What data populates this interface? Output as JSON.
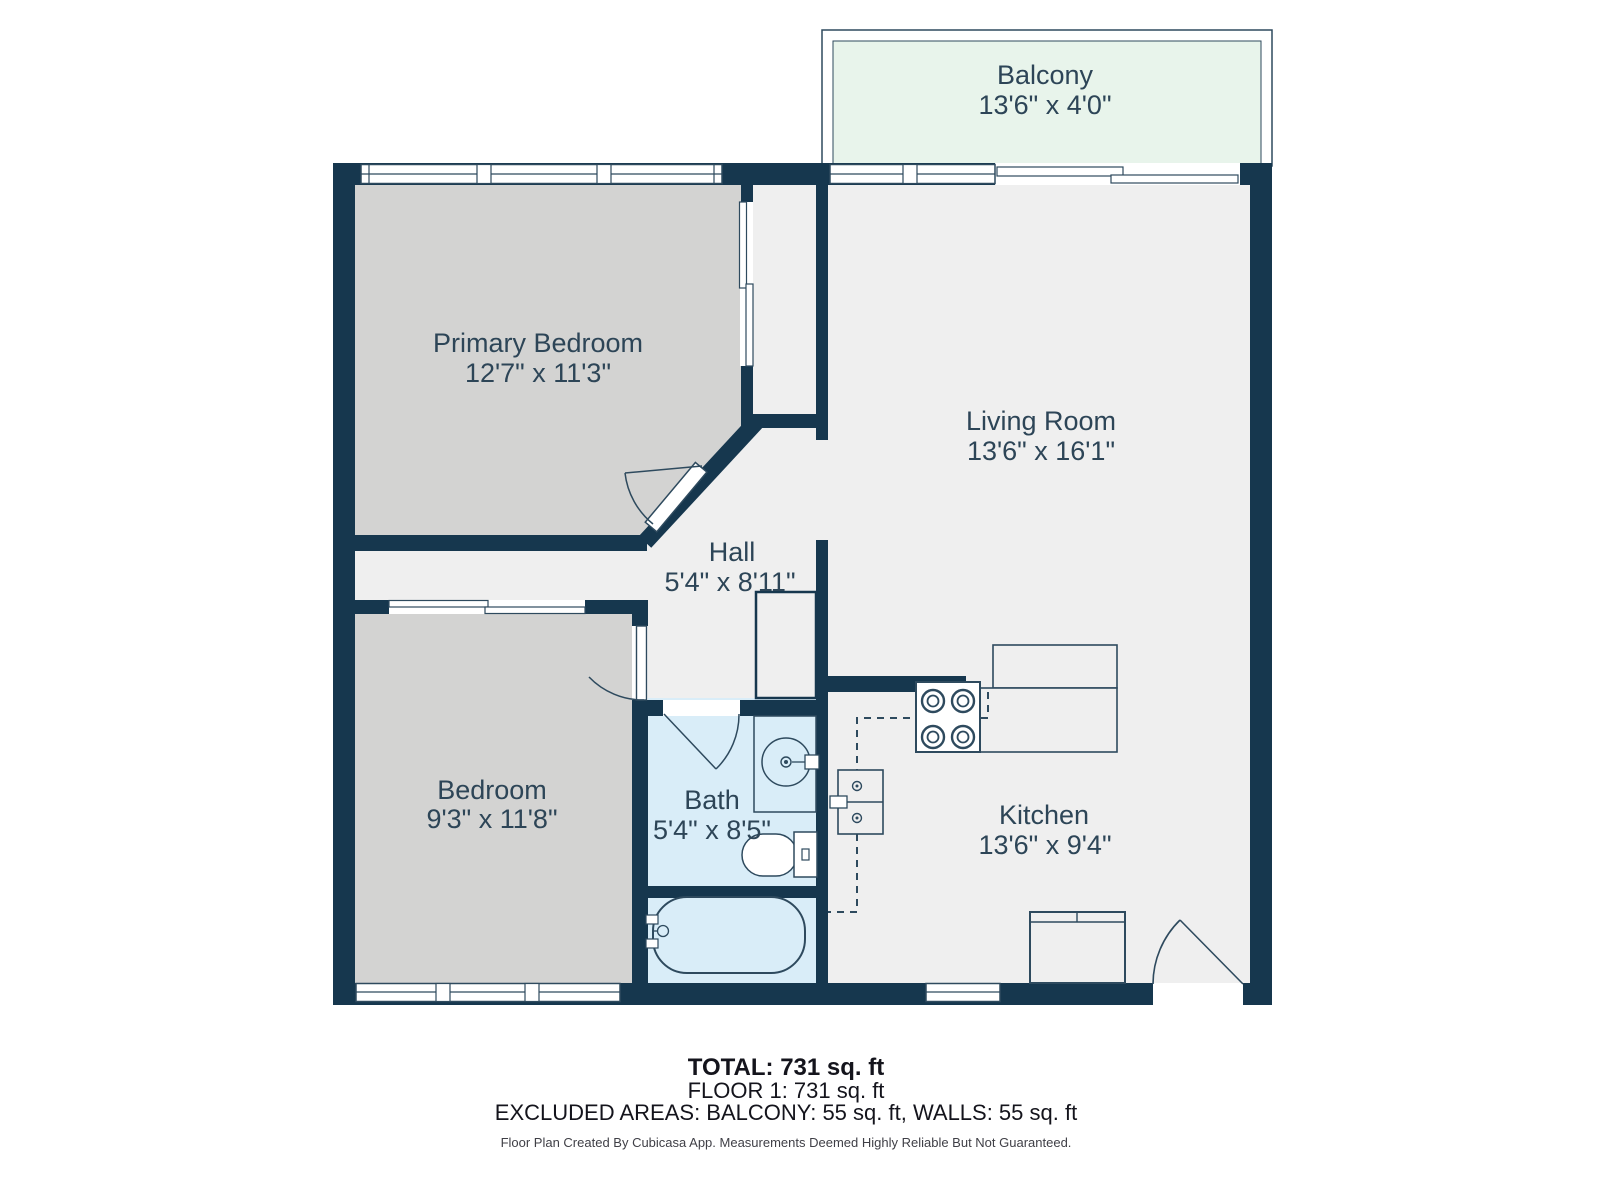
{
  "plan": {
    "rooms": [
      {
        "name": "Balcony",
        "dims": "13'6\" x 4'0\""
      },
      {
        "name": "Primary Bedroom",
        "dims": "12'7\" x 11'3\""
      },
      {
        "name": "Living Room",
        "dims": "13'6\" x 16'1\""
      },
      {
        "name": "Hall",
        "dims": "5'4\" x 8'11\""
      },
      {
        "name": "Bedroom",
        "dims": "9'3\" x 11'8\""
      },
      {
        "name": "Bath",
        "dims": "5'4\" x 8'5\""
      },
      {
        "name": "Kitchen",
        "dims": "13'6\" x 9'4\""
      }
    ],
    "colors": {
      "wall": "#16374e",
      "floor": "#efefef",
      "bedroom_floor": "#d3d3d2",
      "bath_floor": "#d9edf8",
      "balcony_floor": "#e8f4eb",
      "fixture_line": "#2e4a5e",
      "label_text": "#2d4557"
    }
  },
  "footer": {
    "total": "TOTAL: 731 sq. ft",
    "floor": "FLOOR 1: 731 sq. ft",
    "excluded": "EXCLUDED AREAS: BALCONY: 55 sq. ft, WALLS: 55 sq. ft",
    "disclaimer": "Floor Plan Created By Cubicasa App. Measurements Deemed Highly Reliable But Not Guaranteed."
  }
}
